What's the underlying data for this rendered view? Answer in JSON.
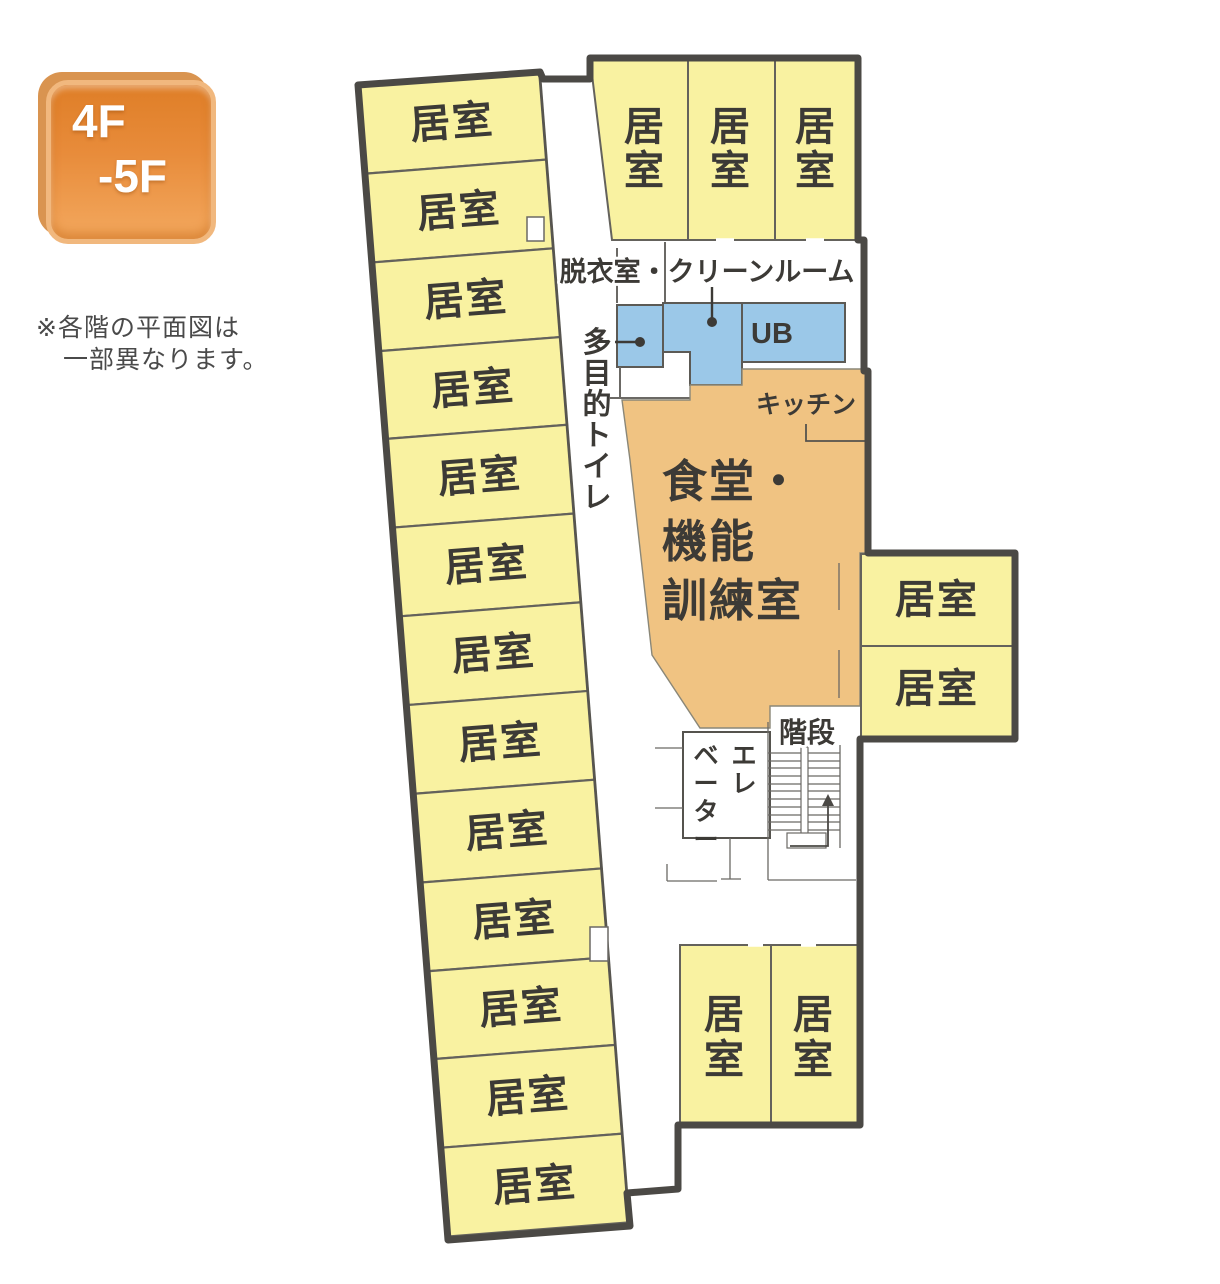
{
  "floor_badge": {
    "line1": "4F",
    "line2": "-5F"
  },
  "note": {
    "line1": "※各階の平面図は",
    "line2": "一部異なります。"
  },
  "colors": {
    "room_yellow": "#F9F2A1",
    "wet_area_blue": "#9BC8E8",
    "common_area_orange": "#F0C382",
    "wall_gray": "#4B4945",
    "badge_orange": "#E2822E"
  },
  "rooms": {
    "left_wing": [
      "居室",
      "居室",
      "居室",
      "居室",
      "居室",
      "居室",
      "居室",
      "居室",
      "居室",
      "居室",
      "居室",
      "居室",
      "居室"
    ],
    "north_wing": [
      "居室",
      "居室",
      "居室"
    ],
    "east_wing": [
      "居室",
      "居室"
    ],
    "south_wing": [
      "居室",
      "居室"
    ]
  },
  "areas": {
    "dressing_clean_room": "脱衣室・クリーンルーム",
    "accessible_toilet": "多目的トイレ",
    "unit_bath": "UB",
    "kitchen": "キッチン",
    "dining_training_lines": [
      "食堂・",
      "機能",
      "訓練室"
    ],
    "stairs": "階段",
    "elevator_col_right": "エレ",
    "elevator_col_left": "ベーター"
  }
}
